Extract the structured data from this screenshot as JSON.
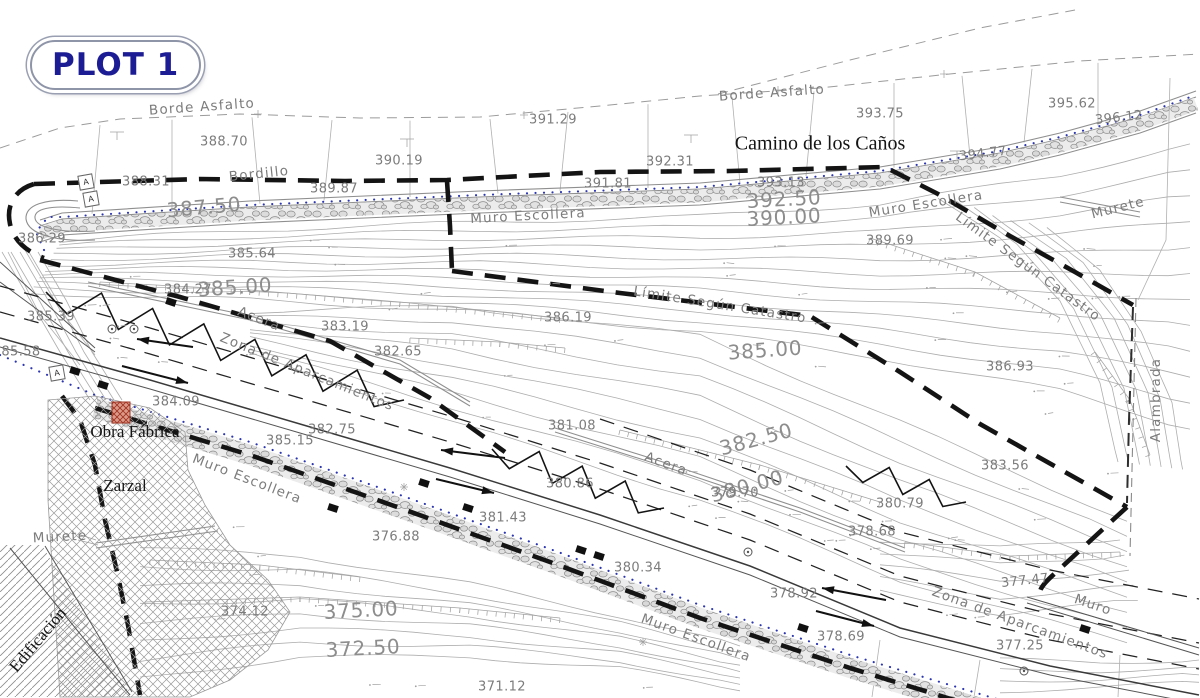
{
  "badge": {
    "label": "PLOT 1"
  },
  "colors": {
    "badge_text": "#1c1c94",
    "boundary": "#141414",
    "blue_dotted": "#2b35b0",
    "contour_gray": "#a8a8a8",
    "label_gray": "#7c7c7c",
    "red_marker": "#b5402f"
  },
  "marker_letter": "A",
  "labels": [
    [
      "Borde Asfalto",
      202,
      107,
      -4,
      "name"
    ],
    [
      "Borde Asfalto",
      772,
      93,
      -4,
      "name"
    ],
    [
      "Camino de los Caños",
      820,
      144,
      0,
      "sf"
    ],
    [
      "388.70",
      224,
      142,
      0,
      "sm"
    ],
    [
      "390.19",
      399,
      161,
      0,
      "sm"
    ],
    [
      "391.29",
      553,
      120,
      0,
      "sm"
    ],
    [
      "392.31",
      670,
      162,
      0,
      "sm"
    ],
    [
      "393.75",
      880,
      114,
      0,
      "sm"
    ],
    [
      "394.77",
      983,
      154,
      -7,
      "sm"
    ],
    [
      "395.62",
      1072,
      104,
      0,
      "sm"
    ],
    [
      "396.12",
      1119,
      118,
      -6,
      "sm"
    ],
    [
      "Murete",
      1118,
      208,
      -14,
      "name"
    ],
    [
      "Bordillo",
      259,
      174,
      -6,
      "name"
    ],
    [
      "389.87",
      334,
      189,
      0,
      "sm"
    ],
    [
      "388.31",
      146,
      182,
      0,
      "sm"
    ],
    [
      "387.50",
      204,
      207,
      -5,
      "lg"
    ],
    [
      "Muro Escollera",
      528,
      216,
      -3,
      "name"
    ],
    [
      "391.81",
      608,
      184,
      0,
      "sm"
    ],
    [
      "393.13",
      781,
      183,
      0,
      "sm"
    ],
    [
      "392.50",
      784,
      199,
      -3,
      "lg"
    ],
    [
      "390.00",
      784,
      217,
      -3,
      "lg"
    ],
    [
      "Muro Escollera",
      926,
      204,
      -9,
      "name"
    ],
    [
      "389.69",
      890,
      241,
      0,
      "sm"
    ],
    [
      "Límite Según Catastro",
      1028,
      267,
      36,
      "name"
    ],
    [
      "386.29",
      42,
      239,
      0,
      "sm"
    ],
    [
      "385.64",
      252,
      254,
      0,
      "sm"
    ],
    [
      "384.27",
      188,
      290,
      0,
      "sm"
    ],
    [
      "385.00",
      235,
      287,
      -4,
      "lg"
    ],
    [
      "Acera",
      259,
      319,
      21,
      "name"
    ],
    [
      "385.39",
      51,
      317,
      0,
      "sm"
    ],
    [
      "85.58",
      21,
      352,
      0,
      "sm"
    ],
    [
      "Zona de Aparcamientos",
      307,
      372,
      22,
      "name"
    ],
    [
      "383.19",
      345,
      327,
      0,
      "sm"
    ],
    [
      "382.65",
      398,
      352,
      0,
      "sm"
    ],
    [
      "386.19",
      568,
      318,
      0,
      "sm"
    ],
    [
      "Límite Según Catastro",
      720,
      305,
      9,
      "name"
    ],
    [
      "385.00",
      765,
      350,
      -4,
      "lg"
    ],
    [
      "386.93",
      1010,
      367,
      0,
      "sm"
    ],
    [
      "384.09",
      176,
      402,
      0,
      "sm"
    ],
    [
      "Obra Fábrica",
      135,
      432,
      0,
      "sfm"
    ],
    [
      "382.75",
      332,
      430,
      0,
      "sm"
    ],
    [
      "385.15",
      290,
      441,
      0,
      "sm"
    ],
    [
      "Zarzal",
      125,
      486,
      0,
      "sfm"
    ],
    [
      "Muro Escollera",
      247,
      479,
      21,
      "name"
    ],
    [
      "376.88",
      396,
      537,
      0,
      "sm"
    ],
    [
      "381.08",
      572,
      426,
      0,
      "sm"
    ],
    [
      "382.50",
      756,
      439,
      -15,
      "lg"
    ],
    [
      "Acera",
      666,
      464,
      20,
      "name"
    ],
    [
      "380.00",
      747,
      486,
      -15,
      "lg"
    ],
    [
      "379.70",
      735,
      493,
      0,
      "sm"
    ],
    [
      "380.86",
      570,
      484,
      0,
      "sm"
    ],
    [
      "383.56",
      1005,
      466,
      0,
      "sm"
    ],
    [
      "380.79",
      900,
      504,
      0,
      "sm"
    ],
    [
      "378.68",
      872,
      532,
      0,
      "sm"
    ],
    [
      "Alambrada",
      1156,
      400,
      -90,
      "name"
    ],
    [
      "381.43",
      503,
      518,
      0,
      "sm"
    ],
    [
      "380.34",
      638,
      568,
      0,
      "sm"
    ],
    [
      "375.00",
      361,
      610,
      -3,
      "lg"
    ],
    [
      "372.50",
      363,
      648,
      -3,
      "lg"
    ],
    [
      "374.12",
      245,
      612,
      0,
      "sm"
    ],
    [
      "Muro Escollera",
      696,
      638,
      20,
      "name"
    ],
    [
      "378.92",
      794,
      594,
      0,
      "sm"
    ],
    [
      "378.69",
      841,
      637,
      0,
      "sm"
    ],
    [
      "377.25",
      1020,
      646,
      0,
      "sm"
    ],
    [
      "Zona de Aparcamientos",
      1020,
      623,
      20,
      "name"
    ],
    [
      "Muro",
      1093,
      605,
      19,
      "name"
    ],
    [
      "377.47",
      1025,
      581,
      -6,
      "sm"
    ],
    [
      "Murete",
      60,
      537,
      -3,
      "name"
    ],
    [
      "Edificación",
      38,
      640,
      -50,
      "sfm"
    ],
    [
      "371.12",
      502,
      687,
      0,
      "sm"
    ]
  ]
}
